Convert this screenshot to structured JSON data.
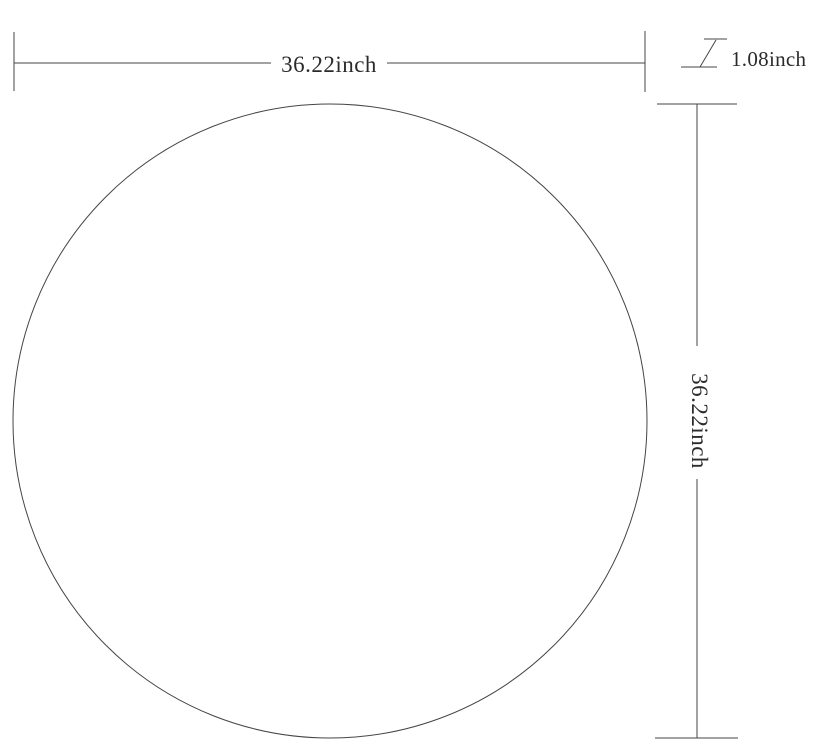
{
  "colors": {
    "background": "#ffffff",
    "line": "#454545",
    "text": "#2b2b2b"
  },
  "diagram": {
    "shape": "circle",
    "width_dimension": {
      "label": "36.22inch"
    },
    "height_dimension": {
      "label": "36.22inch"
    },
    "thickness_dimension": {
      "label": "1.08inch"
    }
  }
}
